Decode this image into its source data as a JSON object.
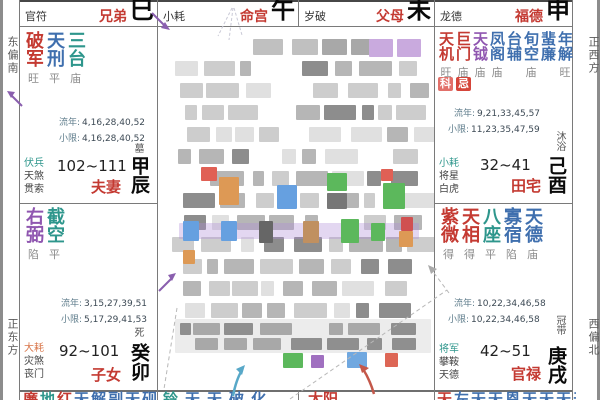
{
  "colors": {
    "main_star_red": "#c43a32",
    "aux_blue": "#3f6fae",
    "aux_teal": "#2e968c",
    "aux_purple": "#8f56b0",
    "shensha_orange": "#d9764a",
    "status_gray": "#8c8c8c",
    "palace_name_red": "#c43a32",
    "badge_ke_bg": "#e2706a",
    "badge_ji_bg": "#d5453a"
  },
  "compass": {
    "top_left": "东偏南",
    "bottom_left": "正东方",
    "top_right": "正西方",
    "bottom_right": "西偏北"
  },
  "labels": {
    "liunian": "流年:",
    "xiaoxian": "小限:"
  },
  "top_strip": [
    {
      "tag": "官符",
      "palace": "兄弟",
      "branch": "巳"
    },
    {
      "tag": "小耗",
      "palace": "命宫",
      "branch": "午"
    },
    {
      "tag": "岁破",
      "palace": "父母",
      "branch": "未"
    },
    {
      "tag": "龙德",
      "palace": "福德",
      "branch": "申"
    }
  ],
  "palaces": {
    "chen": {
      "stars": [
        {
          "name": "破军",
          "c": "r",
          "status": "旺"
        },
        {
          "name": "天刑",
          "c": "b",
          "status": "平"
        },
        {
          "name": "三台",
          "c": "t",
          "status": "庙"
        }
      ],
      "liunian": "4,16,28,40,52",
      "xiaoxian": "4,16,28,40,52",
      "shensha": [
        "伏兵",
        "天煞",
        "贯索"
      ],
      "shensha_color": "t",
      "age_range": "102~111",
      "palace_name": "夫妻",
      "branch": "甲辰",
      "changsheng": "墓"
    },
    "mao": {
      "stars": [
        {
          "name": "右弼",
          "c": "p",
          "status": "陷"
        },
        {
          "name": "截空",
          "c": "t",
          "status": "平"
        }
      ],
      "liunian": "3,15,27,39,51",
      "xiaoxian": "5,17,29,41,53",
      "shensha": [
        "大耗",
        "灾煞",
        "丧门"
      ],
      "shensha_color": "o",
      "age_range": "92~101",
      "palace_name": "子女",
      "branch": "癸卯",
      "changsheng": "死"
    },
    "you": {
      "stars": [
        {
          "name": "天机",
          "c": "r",
          "status": "旺"
        },
        {
          "name": "巨门",
          "c": "r",
          "status": "庙"
        },
        {
          "name": "天钺",
          "c": "p",
          "status": "庙"
        },
        {
          "name": "凤阁",
          "c": "b",
          "status": "庙"
        },
        {
          "name": "台辅",
          "c": "b",
          "status": ""
        },
        {
          "name": "旬空",
          "c": "b",
          "status": "庙"
        },
        {
          "name": "蜚廉",
          "c": "b",
          "status": ""
        },
        {
          "name": "年解",
          "c": "b",
          "status": "旺"
        }
      ],
      "badges": [
        {
          "text": "科",
          "bg": "#e2706a"
        },
        {
          "text": "忌",
          "bg": "#d5453a"
        }
      ],
      "liunian": "9,21,33,45,57",
      "xiaoxian": "11,23,35,47,59",
      "shensha": [
        "小耗",
        "将星",
        "白虎"
      ],
      "shensha_color": "t",
      "age_range": "32~41",
      "palace_name": "田宅",
      "branch": "己酉",
      "changsheng": "沐浴"
    },
    "xu": {
      "stars": [
        {
          "name": "紫微",
          "c": "r",
          "status": "得"
        },
        {
          "name": "天相",
          "c": "r",
          "status": "得"
        },
        {
          "name": "八座",
          "c": "t",
          "status": "平"
        },
        {
          "name": "寡宿",
          "c": "b",
          "status": "陷"
        },
        {
          "name": "天德",
          "c": "b",
          "status": "庙"
        }
      ],
      "liunian": "10,22,34,46,58",
      "xiaoxian": "10,22,34,46,58",
      "shensha": [
        "将军",
        "攀鞍",
        "天德"
      ],
      "shensha_color": "t",
      "age_range": "42~51",
      "palace_name": "官禄",
      "branch": "庚戌",
      "changsheng": "冠带"
    }
  },
  "bottom_strip": [
    {
      "pad": 4,
      "gap": 2,
      "chars": [
        {
          "t": "廉",
          "c": "r"
        },
        {
          "t": "地",
          "c": "t"
        },
        {
          "t": "红",
          "c": "r"
        },
        {
          "t": "天",
          "c": "b"
        },
        {
          "t": "解",
          "c": "b"
        },
        {
          "t": "副",
          "c": "b"
        },
        {
          "t": "天",
          "c": "b"
        },
        {
          "t": "砚",
          "c": "b"
        }
      ]
    },
    {
      "pad": 6,
      "gap": 7,
      "chars": [
        {
          "t": "铃",
          "c": "t"
        },
        {
          "t": "天",
          "c": "b"
        },
        {
          "t": "天",
          "c": "b"
        },
        {
          "t": "破",
          "c": "b"
        },
        {
          "t": "化",
          "c": "b"
        }
      ]
    },
    {
      "pad": 10,
      "gap": 2,
      "chars": [
        {
          "t": "太阳",
          "c": "r"
        }
      ]
    },
    {
      "pad": 3,
      "gap": 0,
      "chars": [
        {
          "t": "天",
          "c": "r"
        },
        {
          "t": "左",
          "c": "b"
        },
        {
          "t": "天",
          "c": "b"
        },
        {
          "t": "天",
          "c": "b"
        },
        {
          "t": "恩",
          "c": "b"
        },
        {
          "t": "天",
          "c": "b"
        },
        {
          "t": "天",
          "c": "b"
        },
        {
          "t": "天",
          "c": "b"
        },
        {
          "t": "天",
          "c": "b"
        }
      ]
    }
  ]
}
